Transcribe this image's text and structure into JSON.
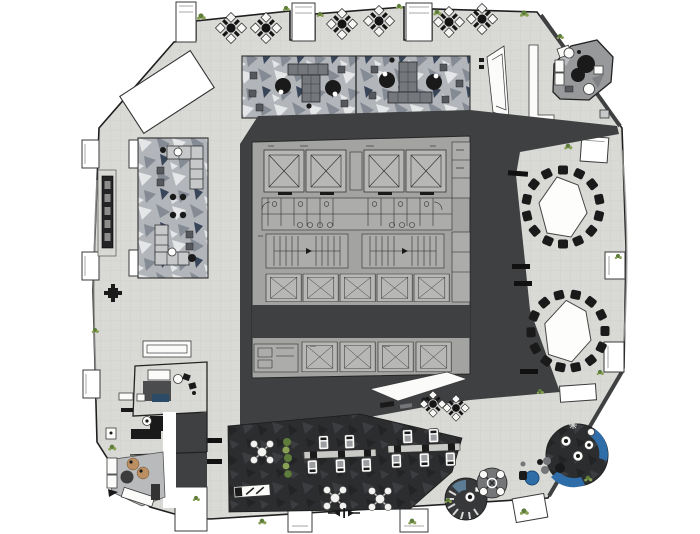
{
  "palette": {
    "page_bg": "#ffffff",
    "floor": "#d9dad6",
    "floor_line": "#c7c9c4",
    "wall": "#1f1f1f",
    "core_dark": "#3f4042",
    "core_panel": "#a3a3a1",
    "core_cell": "#b7b7b5",
    "core_line": "#262626",
    "camo_base": "#b2b5b9",
    "camo_light": "#e4e6e8",
    "camo_mid": "#848b94",
    "camo_navy": "#39465a",
    "cafe_dark": "#2c2d2f",
    "cafe_facet_light": "#3b3d40",
    "cafe_facet_dark": "#232425",
    "lounge_panel": "#b8babb",
    "furn_white": "#fbfbfa",
    "furn_gray": "#737578",
    "furn_dark": "#1a1a1a",
    "table_gray": "#c9c9c6",
    "accent_blue": "#2f6da8",
    "accent_blue_light": "#6e97b8",
    "accent_teal": "#5b7c93",
    "accent_tan": "#bb8f62",
    "plant_green": "#5f7d3a",
    "plant_green_light": "#89a154"
  },
  "plan": {
    "kind": "architectural-floor-plan-top-view",
    "areas": [
      {
        "name": "terrace-north",
        "four-seat-tables": 6
      },
      {
        "name": "lounge-north-camo-carpet",
        "t-shaped-tables": 2,
        "round-tables": 4
      },
      {
        "name": "lounge-northeast-pentagon"
      },
      {
        "name": "escalator-bank-north"
      },
      {
        "name": "building-core",
        "elevators": 13,
        "stairwells": 2,
        "wc-stalls": 8
      },
      {
        "name": "meeting-room-east-upper",
        "conference-chairs": 14
      },
      {
        "name": "meeting-room-east-lower",
        "conference-chairs": 13
      },
      {
        "name": "reception-desk-south-of-core"
      },
      {
        "name": "cafe-south-dark-carpet",
        "round-tables": 3,
        "shared-table-clusters": 2,
        "planter": 1,
        "bench": 1
      },
      {
        "name": "round-lounge-southeast",
        "blue-sofas": 2,
        "mini-tables": 3
      },
      {
        "name": "round-booth-south",
        "segments": true
      },
      {
        "name": "blue-table-set-south"
      },
      {
        "name": "offices-southwest",
        "desks": 2
      },
      {
        "name": "lounge-southwest",
        "tan-tables": 2
      },
      {
        "name": "lounge-west-camo-carpet",
        "modular-sofas": 2
      },
      {
        "name": "calligraphy-sign-west"
      },
      {
        "name": "skylight-northwest"
      }
    ]
  }
}
